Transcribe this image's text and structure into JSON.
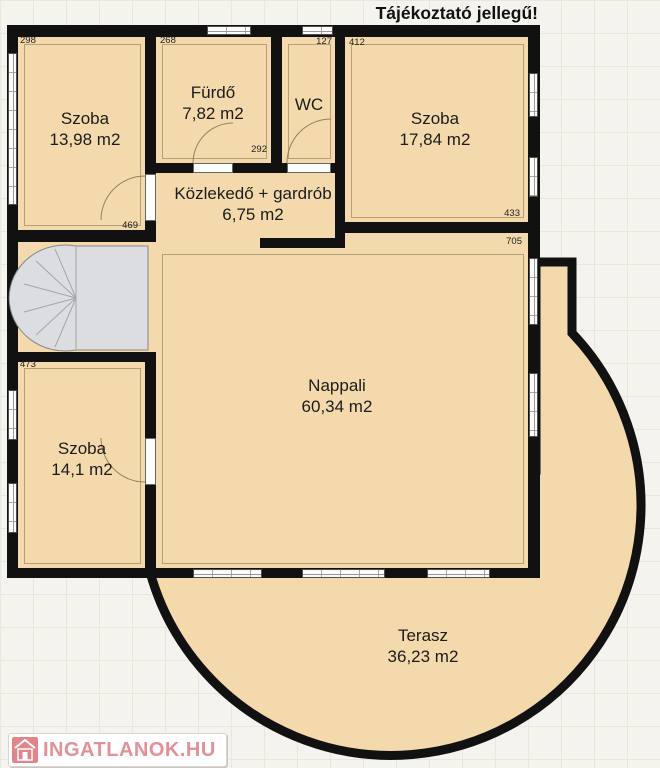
{
  "notice": "Tájékoztató jellegű!",
  "watermark": {
    "text": "INGATLANOK.HU",
    "icon": "house-icon"
  },
  "rooms": [
    {
      "name": "Szoba",
      "area": "13,98 m2"
    },
    {
      "name": "Fürdő",
      "area": "7,82 m2"
    },
    {
      "name": "WC",
      "area": ""
    },
    {
      "name": "Szoba",
      "area": "17,84 m2"
    },
    {
      "name": "Közlekedő + gardrób",
      "area": "6,75 m2"
    },
    {
      "name": "Nappali",
      "area": "60,34 m2"
    },
    {
      "name": "Szoba",
      "area": "14,1 m2"
    },
    {
      "name": "Terasz",
      "area": "36,23 m2"
    }
  ],
  "wall_dimensions_cm": [
    "298",
    "268",
    "127",
    "412",
    "292",
    "469",
    "433",
    "705",
    "473"
  ],
  "colors": {
    "wall": "#111111",
    "room_fill": "#f3d9ab",
    "background": "#f5f3ee",
    "stairs": "#dcdde0",
    "window": "#fbfbf9",
    "watermark_red": "#e29297"
  }
}
